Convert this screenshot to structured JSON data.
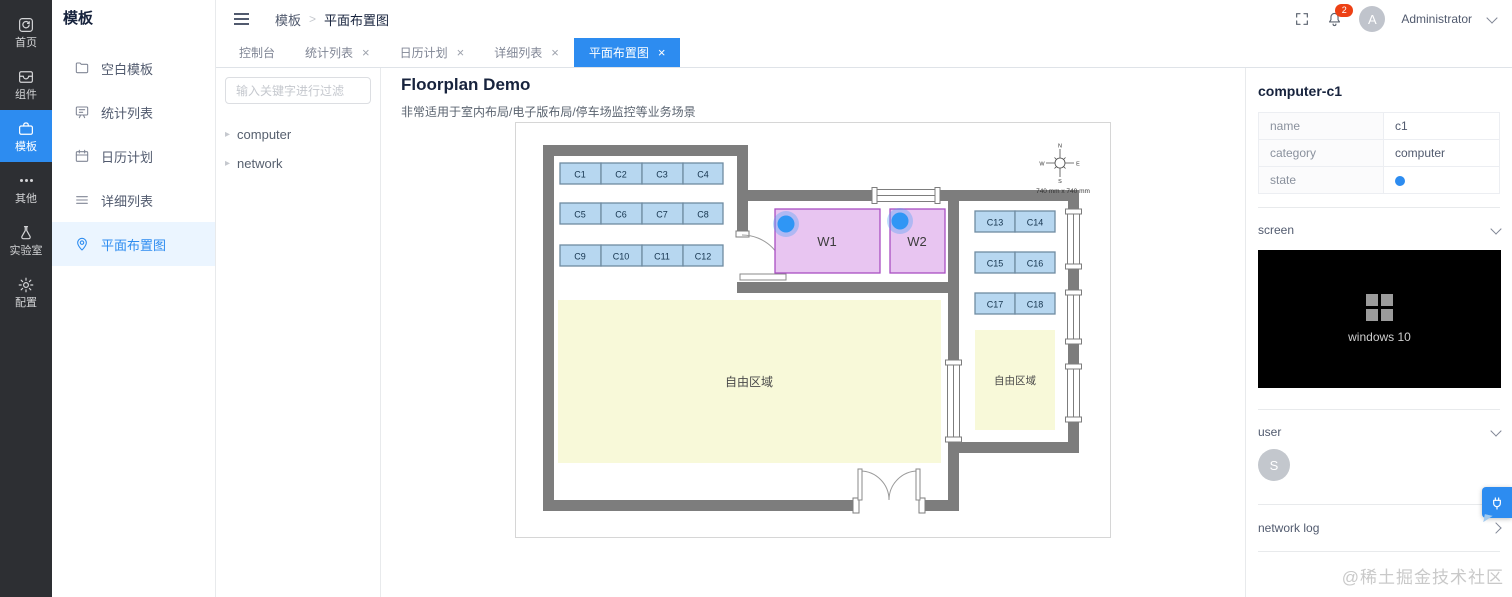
{
  "icons": {
    "close": "×",
    "caret_right": "▸",
    "breadcrumb_sep": ">"
  },
  "primary_nav": {
    "items": [
      {
        "label": "首页"
      },
      {
        "label": "组件"
      },
      {
        "label": "模板",
        "active": true
      },
      {
        "label": "其他"
      },
      {
        "label": "实验室"
      },
      {
        "label": "配置"
      }
    ]
  },
  "secondary_nav": {
    "title": "模板",
    "items": [
      {
        "label": "空白模板"
      },
      {
        "label": "统计列表"
      },
      {
        "label": "日历计划"
      },
      {
        "label": "详细列表"
      },
      {
        "label": "平面布置图",
        "active": true
      }
    ]
  },
  "header": {
    "breadcrumb": [
      "模板",
      "平面布置图"
    ],
    "notification_count": "2",
    "avatar_initial": "A",
    "username": "Administrator"
  },
  "tabs": [
    {
      "label": "控制台"
    },
    {
      "label": "统计列表"
    },
    {
      "label": "日历计划"
    },
    {
      "label": "详细列表"
    },
    {
      "label": "平面布置图",
      "active": true
    }
  ],
  "tree": {
    "search_placeholder": "输入关键字进行过滤",
    "nodes": [
      "computer",
      "network"
    ]
  },
  "floorplan": {
    "title": "Floorplan Demo",
    "subtitle": "非常适用于室内布局/电子版布局/停车场监控等业务场景",
    "desks": [
      "C1",
      "C2",
      "C3",
      "C4",
      "C5",
      "C6",
      "C7",
      "C8",
      "C9",
      "C10",
      "C11",
      "C12",
      "C13",
      "C14",
      "C15",
      "C16",
      "C17",
      "C18"
    ],
    "workstations": [
      "W1",
      "W2"
    ],
    "free_area_main": "自由区域",
    "free_area_side": "自由区域",
    "compass": {
      "n": "N",
      "e": "E",
      "s": "S",
      "w": "W"
    },
    "scale_label": "740 mm x 740 mm"
  },
  "inspector": {
    "title": "computer-c1",
    "rows": [
      {
        "label": "name",
        "value": "c1"
      },
      {
        "label": "category",
        "value": "computer"
      },
      {
        "label": "state",
        "value": ""
      }
    ],
    "screen_section": "screen",
    "screen_os": "windows 10",
    "user_section": "user",
    "user_initial": "S",
    "network_log_section": "network log"
  },
  "watermark": "@稀土掘金技术社区",
  "colors": {
    "accent": "#2d8cf0",
    "badge": "#ed4014",
    "state_dot": "#2d8cf0",
    "desk_fill": "#b7d7f0",
    "room_fill": "#e8c5f1",
    "free_fill": "#f8f9d9",
    "wall": "#7d7d7d"
  }
}
